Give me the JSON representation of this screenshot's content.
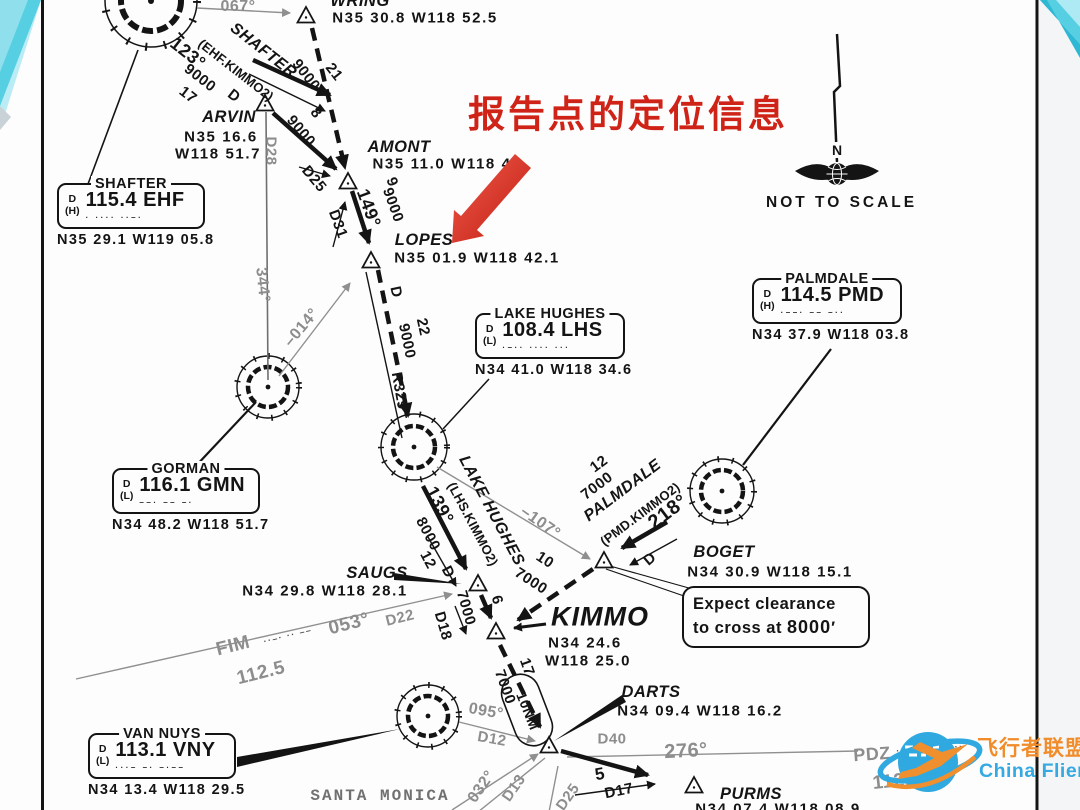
{
  "annotation": {
    "text": "报告点的定位信息",
    "color": "#cf2318"
  },
  "north_indicator": {
    "n_label": "N",
    "caption": "NOT TO SCALE"
  },
  "expect_note": {
    "line1": "Expect clearance",
    "line2_prefix": "to cross at ",
    "altitude": "8000",
    "suffix": "′"
  },
  "watermark": {
    "cn": "飞行者联盟",
    "en": "China Flier",
    "accent_orange": "#f18c2b",
    "accent_blue": "#2fa9e0"
  },
  "colors": {
    "ink": "#141414",
    "gray_radial": "#8d8d8d",
    "red_arrow": "#d93425",
    "teal_decoration": "#57cfe2"
  },
  "navaids": [
    {
      "id": "shafter",
      "name": "SHAFTER",
      "svc": "D",
      "cls": "(H)",
      "freq": "115.4 EHF",
      "morse": "·  ····  ··–·",
      "coords": "N35 29.1 W119 05.8",
      "x": 57,
      "y": 183,
      "w": 148
    },
    {
      "id": "lake-hughes",
      "name": "LAKE HUGHES",
      "svc": "D",
      "cls": "(L)",
      "freq": "108.4 LHS",
      "morse": "·–··  ····  ···",
      "coords": "N34 41.0 W118 34.6",
      "x": 475,
      "y": 313,
      "w": 150
    },
    {
      "id": "palmdale",
      "name": "PALMDALE",
      "svc": "D",
      "cls": "(H)",
      "freq": "114.5 PMD",
      "morse": "·––·  ––  –··",
      "coords": "N34 37.9 W118 03.8",
      "x": 752,
      "y": 278,
      "w": 150
    },
    {
      "id": "gorman",
      "name": "GORMAN",
      "svc": "D",
      "cls": "(L)",
      "freq": "116.1 GMN",
      "morse": "––·  ––  –·",
      "coords": "N34 48.2 W118 51.7",
      "x": 112,
      "y": 468,
      "w": 148
    },
    {
      "id": "van-nuys",
      "name": "VAN NUYS",
      "svc": "D",
      "cls": "(L)",
      "freq": "113.1 VNY",
      "morse": "···–  –·  –·––",
      "coords": "N34 13.4 W118 29.5",
      "x": 88,
      "y": 733,
      "w": 148
    }
  ],
  "fixes": [
    {
      "name": "WRING",
      "coords": "N35 30.8 W118 52.5"
    },
    {
      "name": "ARVIN",
      "coords": "N35 16.6 W118 51.7"
    },
    {
      "name": "AMONT",
      "coords": "N35 11.0 W118 45"
    },
    {
      "name": "LOPES",
      "coords": "N35 01.9 W118 42.1"
    },
    {
      "name": "SAUGS",
      "coords": "N34 29.8 W118 28.1"
    },
    {
      "name": "KIMMO",
      "coords": "N34 24.6 W118 25.0"
    },
    {
      "name": "BOGET",
      "coords": "N34 30.9 W118 15.1"
    },
    {
      "name": "DARTS",
      "coords": "N34 09.4 W118 16.2"
    },
    {
      "name": "PURMS",
      "coords": "N34 07.4 W118 08.9"
    }
  ],
  "chart": {
    "labels": [
      {
        "t": "WRING",
        "x": 360,
        "y": 1,
        "r": 0,
        "c": "fx",
        "n": "fix-wring-name"
      },
      {
        "t": "N35 30.8 W118 52.5",
        "x": 415,
        "y": 18,
        "r": 0,
        "c": "co",
        "n": "fix-wring-coords"
      },
      {
        "t": "067°",
        "x": 238,
        "y": 7,
        "r": 0,
        "c": "gy",
        "n": "radial-067"
      },
      {
        "t": "SHAFTER",
        "x": 263,
        "y": 51,
        "r": 38,
        "c": "tr",
        "n": "transition-shafter"
      },
      {
        "t": "(EHF.KIMMO2)",
        "x": 236,
        "y": 70,
        "r": 38,
        "c": "pr",
        "n": "transition-shafter-code"
      },
      {
        "t": "123°",
        "x": 188,
        "y": 53,
        "r": 38,
        "c": "rt",
        "s": 18,
        "n": "course-123"
      },
      {
        "t": "9000",
        "x": 200,
        "y": 78,
        "r": 38,
        "c": "rt",
        "n": "alt-9000-shafter"
      },
      {
        "t": "17",
        "x": 188,
        "y": 95,
        "r": 38,
        "c": "rt",
        "n": "dist-17"
      },
      {
        "t": "D",
        "x": 234,
        "y": 96,
        "r": 38,
        "c": "rt",
        "n": "dme-d-shafter"
      },
      {
        "t": "9000",
        "x": 306,
        "y": 75,
        "r": 52,
        "c": "rt",
        "n": "alt-9000-wring"
      },
      {
        "t": "21",
        "x": 334,
        "y": 72,
        "r": 52,
        "c": "rt",
        "n": "dist-21"
      },
      {
        "t": "ARVIN",
        "x": 229,
        "y": 117,
        "r": 0,
        "c": "fx",
        "n": "fix-arvin-name"
      },
      {
        "t": "N35 16.6",
        "x": 221,
        "y": 137,
        "r": 0,
        "c": "co",
        "n": "fix-arvin-lat"
      },
      {
        "t": "W118 51.7",
        "x": 218,
        "y": 154,
        "r": 0,
        "c": "co",
        "n": "fix-arvin-lon"
      },
      {
        "t": "D28",
        "x": 271,
        "y": 151,
        "r": 90,
        "c": "gy",
        "s": 15,
        "n": "dme-d28"
      },
      {
        "t": "9000",
        "x": 301,
        "y": 131,
        "r": 50,
        "c": "rt",
        "n": "alt-9000-arvin"
      },
      {
        "t": "8",
        "x": 316,
        "y": 113,
        "r": 50,
        "c": "rt",
        "n": "dist-8"
      },
      {
        "t": "D25",
        "x": 314,
        "y": 179,
        "r": 50,
        "c": "rt",
        "s": 15,
        "n": "dme-d25"
      },
      {
        "t": "AMONT",
        "x": 399,
        "y": 147,
        "r": 0,
        "c": "fx",
        "n": "fix-amont-name"
      },
      {
        "t": "N35 11.0 W118 45",
        "x": 447,
        "y": 164,
        "r": 0,
        "c": "co",
        "n": "fix-amont-coords"
      },
      {
        "t": "149°",
        "x": 369,
        "y": 208,
        "r": 70,
        "c": "rt",
        "s": 18,
        "n": "course-149"
      },
      {
        "t": "9",
        "x": 392,
        "y": 182,
        "r": 70,
        "c": "rt",
        "n": "dist-9"
      },
      {
        "t": "9000",
        "x": 393,
        "y": 205,
        "r": 70,
        "c": "rt",
        "n": "alt-9000-amont"
      },
      {
        "t": "D31",
        "x": 338,
        "y": 224,
        "r": 70,
        "c": "rt",
        "s": 15,
        "n": "dme-d31"
      },
      {
        "t": "LOPES",
        "x": 424,
        "y": 240,
        "r": 0,
        "c": "fx",
        "n": "fix-lopes-name"
      },
      {
        "t": "N35 01.9 W118 42.1",
        "x": 477,
        "y": 258,
        "r": 0,
        "c": "co",
        "n": "fix-lopes-coords"
      },
      {
        "t": "D",
        "x": 396,
        "y": 292,
        "r": 78,
        "c": "rt",
        "n": "dme-d-lopes"
      },
      {
        "t": "9000",
        "x": 407,
        "y": 341,
        "r": 78,
        "c": "rt",
        "n": "alt-9000-lopes"
      },
      {
        "t": "22",
        "x": 423,
        "y": 327,
        "r": 78,
        "c": "rt",
        "n": "dist-22"
      },
      {
        "t": "R329°",
        "x": 400,
        "y": 394,
        "r": 80,
        "c": "rt",
        "s": 15,
        "n": "radial-r329"
      },
      {
        "t": "344°",
        "x": 262,
        "y": 285,
        "r": 84,
        "c": "gy",
        "n": "radial-344"
      },
      {
        "t": "–014°",
        "x": 302,
        "y": 328,
        "r": -50,
        "c": "gy",
        "n": "radial-014"
      },
      {
        "t": "139°",
        "x": 440,
        "y": 505,
        "r": 62,
        "c": "rt",
        "s": 18,
        "n": "course-139"
      },
      {
        "t": "LAKE HUGHES",
        "x": 491,
        "y": 511,
        "r": 62,
        "c": "tr",
        "n": "transition-lake-hughes"
      },
      {
        "t": "(LHS.KIMMO2)",
        "x": 473,
        "y": 524,
        "r": 62,
        "c": "pr",
        "n": "transition-lake-hughes-code"
      },
      {
        "t": "8000",
        "x": 428,
        "y": 534,
        "r": 62,
        "c": "rt",
        "n": "alt-8000"
      },
      {
        "t": "12",
        "x": 428,
        "y": 560,
        "r": 62,
        "c": "rt",
        "n": "dist-12-lhs"
      },
      {
        "t": "D",
        "x": 448,
        "y": 572,
        "r": 62,
        "c": "rt",
        "n": "dme-d-lhs"
      },
      {
        "t": "7000",
        "x": 466,
        "y": 608,
        "r": 74,
        "c": "rt",
        "n": "alt-7000-saugs"
      },
      {
        "t": "6",
        "x": 497,
        "y": 600,
        "r": 74,
        "c": "rt",
        "n": "dist-6"
      },
      {
        "t": "D18",
        "x": 443,
        "y": 626,
        "r": 74,
        "c": "rt",
        "s": 15,
        "n": "dme-d18"
      },
      {
        "t": "–107°",
        "x": 540,
        "y": 523,
        "r": 35,
        "c": "gy",
        "n": "radial-107"
      },
      {
        "t": "12",
        "x": 599,
        "y": 464,
        "r": -37,
        "c": "rt",
        "n": "dist-12-pmd"
      },
      {
        "t": "7000",
        "x": 597,
        "y": 486,
        "r": -37,
        "c": "rt",
        "n": "alt-7000-pmd"
      },
      {
        "t": "PALMDALE",
        "x": 623,
        "y": 491,
        "r": -37,
        "c": "tr",
        "n": "transition-palmdale"
      },
      {
        "t": "(PMD.KIMMO2)",
        "x": 640,
        "y": 514,
        "r": -37,
        "c": "pr",
        "n": "transition-palmdale-code"
      },
      {
        "t": "218°",
        "x": 668,
        "y": 512,
        "r": -37,
        "c": "rt",
        "s": 20,
        "n": "course-218"
      },
      {
        "t": "D",
        "x": 650,
        "y": 559,
        "r": -40,
        "c": "rt",
        "n": "dme-d-pmd"
      },
      {
        "t": "BOGET",
        "x": 724,
        "y": 552,
        "r": 0,
        "c": "fx",
        "n": "fix-boget-name"
      },
      {
        "t": "N34 30.9 W118 15.1",
        "x": 770,
        "y": 572,
        "r": 0,
        "c": "co",
        "n": "fix-boget-coords"
      },
      {
        "t": "10",
        "x": 545,
        "y": 560,
        "r": 33,
        "c": "rt",
        "n": "dist-10"
      },
      {
        "t": "7000",
        "x": 531,
        "y": 581,
        "r": 33,
        "c": "rt",
        "n": "alt-7000-boget"
      },
      {
        "t": "SAUGS",
        "x": 377,
        "y": 573,
        "r": 0,
        "c": "fx",
        "n": "fix-saugs-name"
      },
      {
        "t": "N34 29.8 W118 28.1",
        "x": 325,
        "y": 591,
        "r": 0,
        "c": "co",
        "n": "fix-saugs-coords"
      },
      {
        "t": "FIM",
        "x": 233,
        "y": 646,
        "r": -14,
        "c": "gy",
        "s": 19,
        "n": "navaid-fim"
      },
      {
        "t": "··–· ·· ––",
        "x": 288,
        "y": 636,
        "r": -14,
        "c": "mor",
        "n": "fim-morse"
      },
      {
        "t": "053°",
        "x": 349,
        "y": 624,
        "r": -14,
        "c": "gy",
        "s": 19,
        "n": "radial-053"
      },
      {
        "t": "D22",
        "x": 400,
        "y": 618,
        "r": -14,
        "c": "gy",
        "s": 15,
        "n": "dme-d22"
      },
      {
        "t": "112.5",
        "x": 261,
        "y": 673,
        "r": -14,
        "c": "gy",
        "s": 19,
        "n": "fim-freq"
      },
      {
        "t": "KIMMO",
        "x": 600,
        "y": 617,
        "r": 0,
        "c": "fxb",
        "n": "fix-kimmo-name"
      },
      {
        "t": "N34 24.6",
        "x": 585,
        "y": 643,
        "r": 0,
        "c": "co",
        "n": "fix-kimmo-lat"
      },
      {
        "t": "W118 25.0",
        "x": 588,
        "y": 661,
        "r": 0,
        "c": "co",
        "n": "fix-kimmo-lon"
      },
      {
        "t": "17",
        "x": 527,
        "y": 667,
        "r": 70,
        "c": "rt",
        "n": "dist-17-kimmo"
      },
      {
        "t": "7000",
        "x": 505,
        "y": 687,
        "r": 70,
        "c": "rt",
        "n": "alt-7000-kimmo"
      },
      {
        "t": "10NM",
        "x": 528,
        "y": 711,
        "r": 68,
        "c": "rt",
        "s": 14,
        "n": "holding-10nm"
      },
      {
        "t": "DARTS",
        "x": 651,
        "y": 692,
        "r": 0,
        "c": "fx",
        "n": "fix-darts-name"
      },
      {
        "t": "N34 09.4 W118 16.2",
        "x": 700,
        "y": 711,
        "r": 0,
        "c": "co",
        "n": "fix-darts-coords"
      },
      {
        "t": "D40",
        "x": 612,
        "y": 739,
        "r": 0,
        "c": "gy",
        "s": 15,
        "n": "dme-d40"
      },
      {
        "t": "276°",
        "x": 686,
        "y": 751,
        "r": -3,
        "c": "gy",
        "s": 20,
        "n": "radial-276"
      },
      {
        "t": "095°",
        "x": 486,
        "y": 712,
        "r": 10,
        "c": "gy",
        "n": "radial-095"
      },
      {
        "t": "D12",
        "x": 492,
        "y": 739,
        "r": 10,
        "c": "gy",
        "s": 15,
        "n": "dme-d12"
      },
      {
        "t": "032°",
        "x": 482,
        "y": 787,
        "r": -55,
        "c": "gy",
        "n": "radial-032"
      },
      {
        "t": "D13",
        "x": 514,
        "y": 788,
        "r": -55,
        "c": "gy",
        "s": 15,
        "n": "dme-d13"
      },
      {
        "t": "D25",
        "x": 568,
        "y": 797,
        "r": -55,
        "c": "gy",
        "s": 15,
        "n": "dme-d25-smo"
      },
      {
        "t": "5",
        "x": 600,
        "y": 774,
        "r": -10,
        "c": "rt",
        "s": 17,
        "n": "dist-5"
      },
      {
        "t": "D17",
        "x": 619,
        "y": 791,
        "r": -12,
        "c": "rt",
        "s": 15,
        "n": "dme-d17"
      },
      {
        "t": "PURMS",
        "x": 751,
        "y": 794,
        "r": 0,
        "c": "fx",
        "n": "fix-purms-name"
      },
      {
        "t": "N34 07.4 W118 08.9",
        "x": 778,
        "y": 809,
        "r": 0,
        "c": "co",
        "n": "fix-purms-coords"
      },
      {
        "t": "PDZ",
        "x": 872,
        "y": 754,
        "r": -4,
        "c": "gy",
        "s": 18,
        "n": "navaid-pdz"
      },
      {
        "t": "·––· –·· ––··",
        "x": 930,
        "y": 749,
        "r": -4,
        "c": "mor",
        "n": "pdz-morse"
      },
      {
        "t": "112.2",
        "x": 897,
        "y": 781,
        "r": -6,
        "c": "gy",
        "s": 19,
        "n": "pdz-freq"
      },
      {
        "t": "SANTA MONICA",
        "x": 380,
        "y": 796,
        "r": 0,
        "c": "tw",
        "n": "label-santa-monica"
      }
    ]
  }
}
